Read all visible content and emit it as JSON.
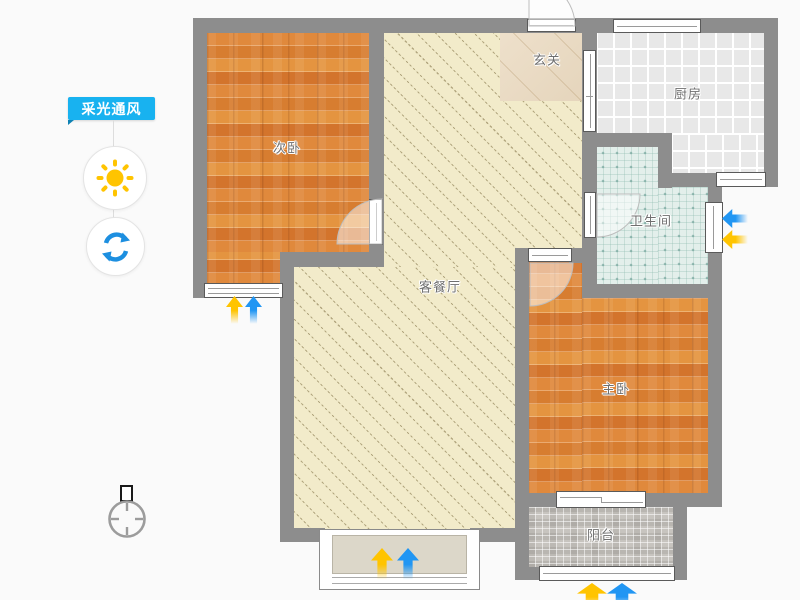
{
  "app": {
    "background": "#fafafa"
  },
  "sidebar": {
    "tool_group_label": "采光通风",
    "accent_color": "#18b2f0",
    "buttons": [
      {
        "id": "sunlight",
        "icon": "sun-icon",
        "color": "#ffc400"
      },
      {
        "id": "ventilation",
        "icon": "refresh-icon",
        "color": "#1d8fe0"
      }
    ]
  },
  "floorplan": {
    "wall_color": "#8d8d8d",
    "rooms": [
      {
        "id": "secondary-bedroom",
        "label": "次卧",
        "floor": "wood-plank",
        "floor_color": "#dc8034"
      },
      {
        "id": "entry-hall",
        "label": "玄关",
        "floor": "marble",
        "floor_color": "#e9dbc6"
      },
      {
        "id": "kitchen",
        "label": "厨房",
        "floor": "ceramic-tile",
        "floor_color": "#e8e8e8"
      },
      {
        "id": "bathroom",
        "label": "卫生间",
        "floor": "teal-mosaic",
        "floor_color": "#e3efeb"
      },
      {
        "id": "living-dining",
        "label": "客餐厅",
        "floor": "diagonal-hatch",
        "floor_color": "#f2ebca"
      },
      {
        "id": "master-bedroom",
        "label": "主卧",
        "floor": "wood-plank",
        "floor_color": "#dc8034"
      },
      {
        "id": "balcony",
        "label": "阳台",
        "floor": "gray-mosaic",
        "floor_color": "#c7c4bf"
      }
    ],
    "indicators": {
      "sunlight_arrow_color": "#ffc400",
      "wind_arrow_color": "#2196f3"
    },
    "compass": {
      "id": "north-indicator"
    }
  }
}
